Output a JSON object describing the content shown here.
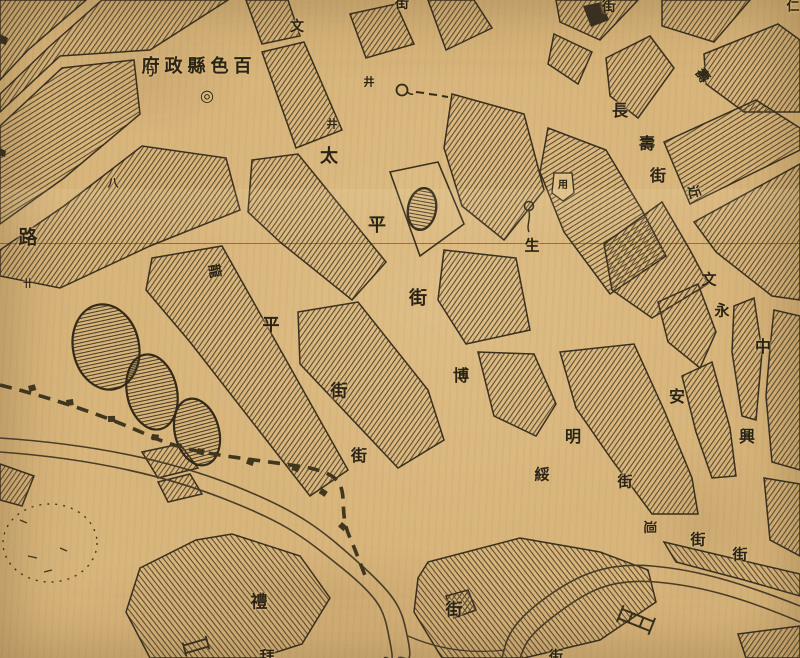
{
  "map": {
    "kind": "historical city street map (scanned, aged paper with fold crease)",
    "colors": {
      "paper": "#d8b57b",
      "ink": "#3a3020",
      "hatch": "#4e4028",
      "water_ink": "#4a3d28",
      "label_ink": "#2b2316"
    },
    "labels": [
      {
        "name": "county-government-label",
        "text": "府政縣色百",
        "x": 199,
        "y": 67,
        "size": 18,
        "ls": 5
      },
      {
        "name": "government-seat-symbol",
        "text": "◎",
        "x": 207,
        "y": 96,
        "size": 16
      },
      {
        "name": "road-label-char",
        "text": "路",
        "x": 28,
        "y": 238,
        "size": 19
      },
      {
        "name": "well-icon",
        "text": "井",
        "x": 369,
        "y": 82,
        "size": 11
      },
      {
        "name": "well-icon",
        "text": "井",
        "x": 332,
        "y": 124,
        "size": 11
      },
      {
        "name": "taiping-street-char",
        "text": "太",
        "x": 329,
        "y": 157,
        "size": 18
      },
      {
        "name": "taiping-street-char",
        "text": "平",
        "x": 377,
        "y": 226,
        "size": 18
      },
      {
        "name": "taiping-street-char",
        "text": "街",
        "x": 418,
        "y": 299,
        "size": 18
      },
      {
        "name": "longping-street-char",
        "text": "龍",
        "x": 214,
        "y": 271,
        "size": 14,
        "rot": 80
      },
      {
        "name": "longping-street-char",
        "text": "平",
        "x": 271,
        "y": 326,
        "size": 17
      },
      {
        "name": "longping-street-char",
        "text": "街",
        "x": 339,
        "y": 392,
        "size": 17
      },
      {
        "name": "street-end-char",
        "text": "街",
        "x": 359,
        "y": 456,
        "size": 16
      },
      {
        "name": "street-end-char",
        "text": "街",
        "x": 454,
        "y": 611,
        "size": 17
      },
      {
        "name": "changshou-street-char",
        "text": "長",
        "x": 620,
        "y": 111,
        "size": 16
      },
      {
        "name": "changshou-street-char",
        "text": "壽",
        "x": 647,
        "y": 144,
        "size": 16
      },
      {
        "name": "changshou-street-char",
        "text": "街",
        "x": 658,
        "y": 176,
        "size": 16
      },
      {
        "name": "shou-street-char-rotated",
        "text": "壽",
        "x": 702,
        "y": 76,
        "size": 14,
        "rot": 55
      },
      {
        "name": "street-char-rotated",
        "text": "近",
        "x": 693,
        "y": 192,
        "size": 13,
        "rot": 75
      },
      {
        "name": "street-top-char",
        "text": "街",
        "x": 609,
        "y": 7,
        "size": 14
      },
      {
        "name": "street-top-char",
        "text": "文",
        "x": 297,
        "y": 27,
        "size": 14
      },
      {
        "name": "street-top-char",
        "text": "街",
        "x": 402,
        "y": 4,
        "size": 14
      },
      {
        "name": "sheng-char",
        "text": "生",
        "x": 532,
        "y": 246,
        "size": 15
      },
      {
        "name": "yong-building-char",
        "text": "用",
        "x": 563,
        "y": 186,
        "size": 10
      },
      {
        "name": "bo-street-char",
        "text": "博",
        "x": 461,
        "y": 376,
        "size": 16
      },
      {
        "name": "sui-street-char",
        "text": "綏",
        "x": 542,
        "y": 475,
        "size": 15
      },
      {
        "name": "ming-street-char",
        "text": "明",
        "x": 573,
        "y": 437,
        "size": 16
      },
      {
        "name": "street-end-char",
        "text": "街",
        "x": 625,
        "y": 482,
        "size": 15
      },
      {
        "name": "street-char-rotated",
        "text": "迴",
        "x": 649,
        "y": 527,
        "size": 13,
        "rot": 90
      },
      {
        "name": "street-end-char",
        "text": "街",
        "x": 698,
        "y": 540,
        "size": 15
      },
      {
        "name": "street-end-char",
        "text": "街",
        "x": 740,
        "y": 555,
        "size": 15
      },
      {
        "name": "wenyong-street-char",
        "text": "文",
        "x": 709,
        "y": 280,
        "size": 15
      },
      {
        "name": "wenyong-street-char",
        "text": "永",
        "x": 722,
        "y": 311,
        "size": 15
      },
      {
        "name": "yongan-street-char",
        "text": "安",
        "x": 677,
        "y": 397,
        "size": 16
      },
      {
        "name": "zhongxing-street-char",
        "text": "中",
        "x": 763,
        "y": 347,
        "size": 16
      },
      {
        "name": "zhongxing-street-char",
        "text": "興",
        "x": 747,
        "y": 437,
        "size": 16
      },
      {
        "name": "li-building-char",
        "text": "禮",
        "x": 259,
        "y": 603,
        "size": 17
      },
      {
        "name": "partial-edge-char",
        "text": "拜",
        "x": 267,
        "y": 657,
        "size": 15
      },
      {
        "name": "partial-edge-char",
        "text": "街",
        "x": 556,
        "y": 657,
        "size": 14
      },
      {
        "name": "partial-edge-char",
        "text": "仁",
        "x": 793,
        "y": 7,
        "size": 13
      },
      {
        "name": "annotation-mark",
        "text": "ㄅ",
        "x": 150,
        "y": 72,
        "size": 11
      },
      {
        "name": "annotation-mark",
        "text": "八",
        "x": 113,
        "y": 183,
        "size": 11
      },
      {
        "name": "annotation-mark",
        "text": "卄",
        "x": 28,
        "y": 285,
        "size": 10
      }
    ]
  }
}
